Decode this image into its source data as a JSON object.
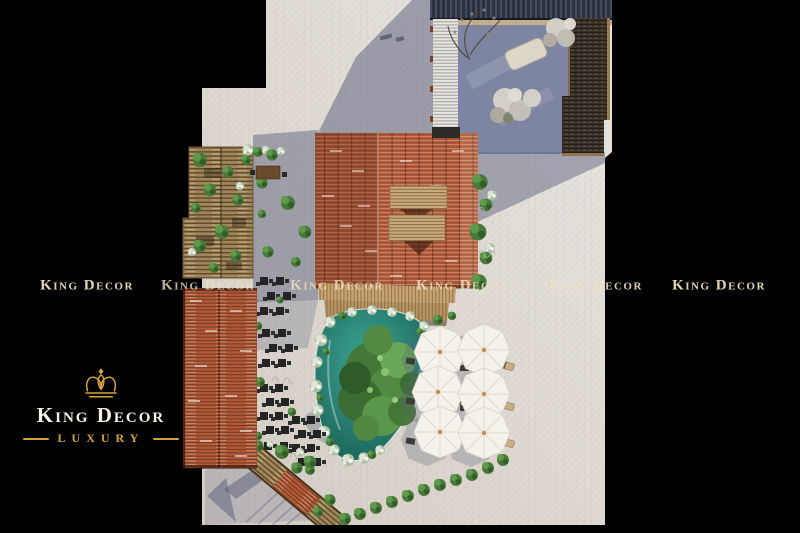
{
  "brand": {
    "name": "King Decor",
    "gold": "#d2a43c",
    "cream": "#ece0c2"
  },
  "logo": {
    "title": "King Decor",
    "subtitle": "LUXURY",
    "icon": "crown-icon"
  },
  "watermarks": [
    {
      "text": "King Decor",
      "x": 87,
      "y": 286,
      "opacity": 0.95
    },
    {
      "text": "King Decor",
      "x": 208,
      "y": 286,
      "opacity": 0.8
    },
    {
      "text": "King Decor",
      "x": 337,
      "y": 286,
      "opacity": 0.8
    },
    {
      "text": "King Decor",
      "x": 463,
      "y": 286,
      "opacity": 0.85
    },
    {
      "text": "King Decor",
      "x": 596,
      "y": 286,
      "opacity": 0.9
    },
    {
      "text": "King Decor",
      "x": 719,
      "y": 286,
      "opacity": 0.95
    }
  ],
  "scene": {
    "umbrella_count": 6,
    "pool_color": "#2c9584",
    "roof_terracotta": "#b45e3d",
    "paving_color": "#ddd6cf",
    "shadow_color": "#606682"
  }
}
